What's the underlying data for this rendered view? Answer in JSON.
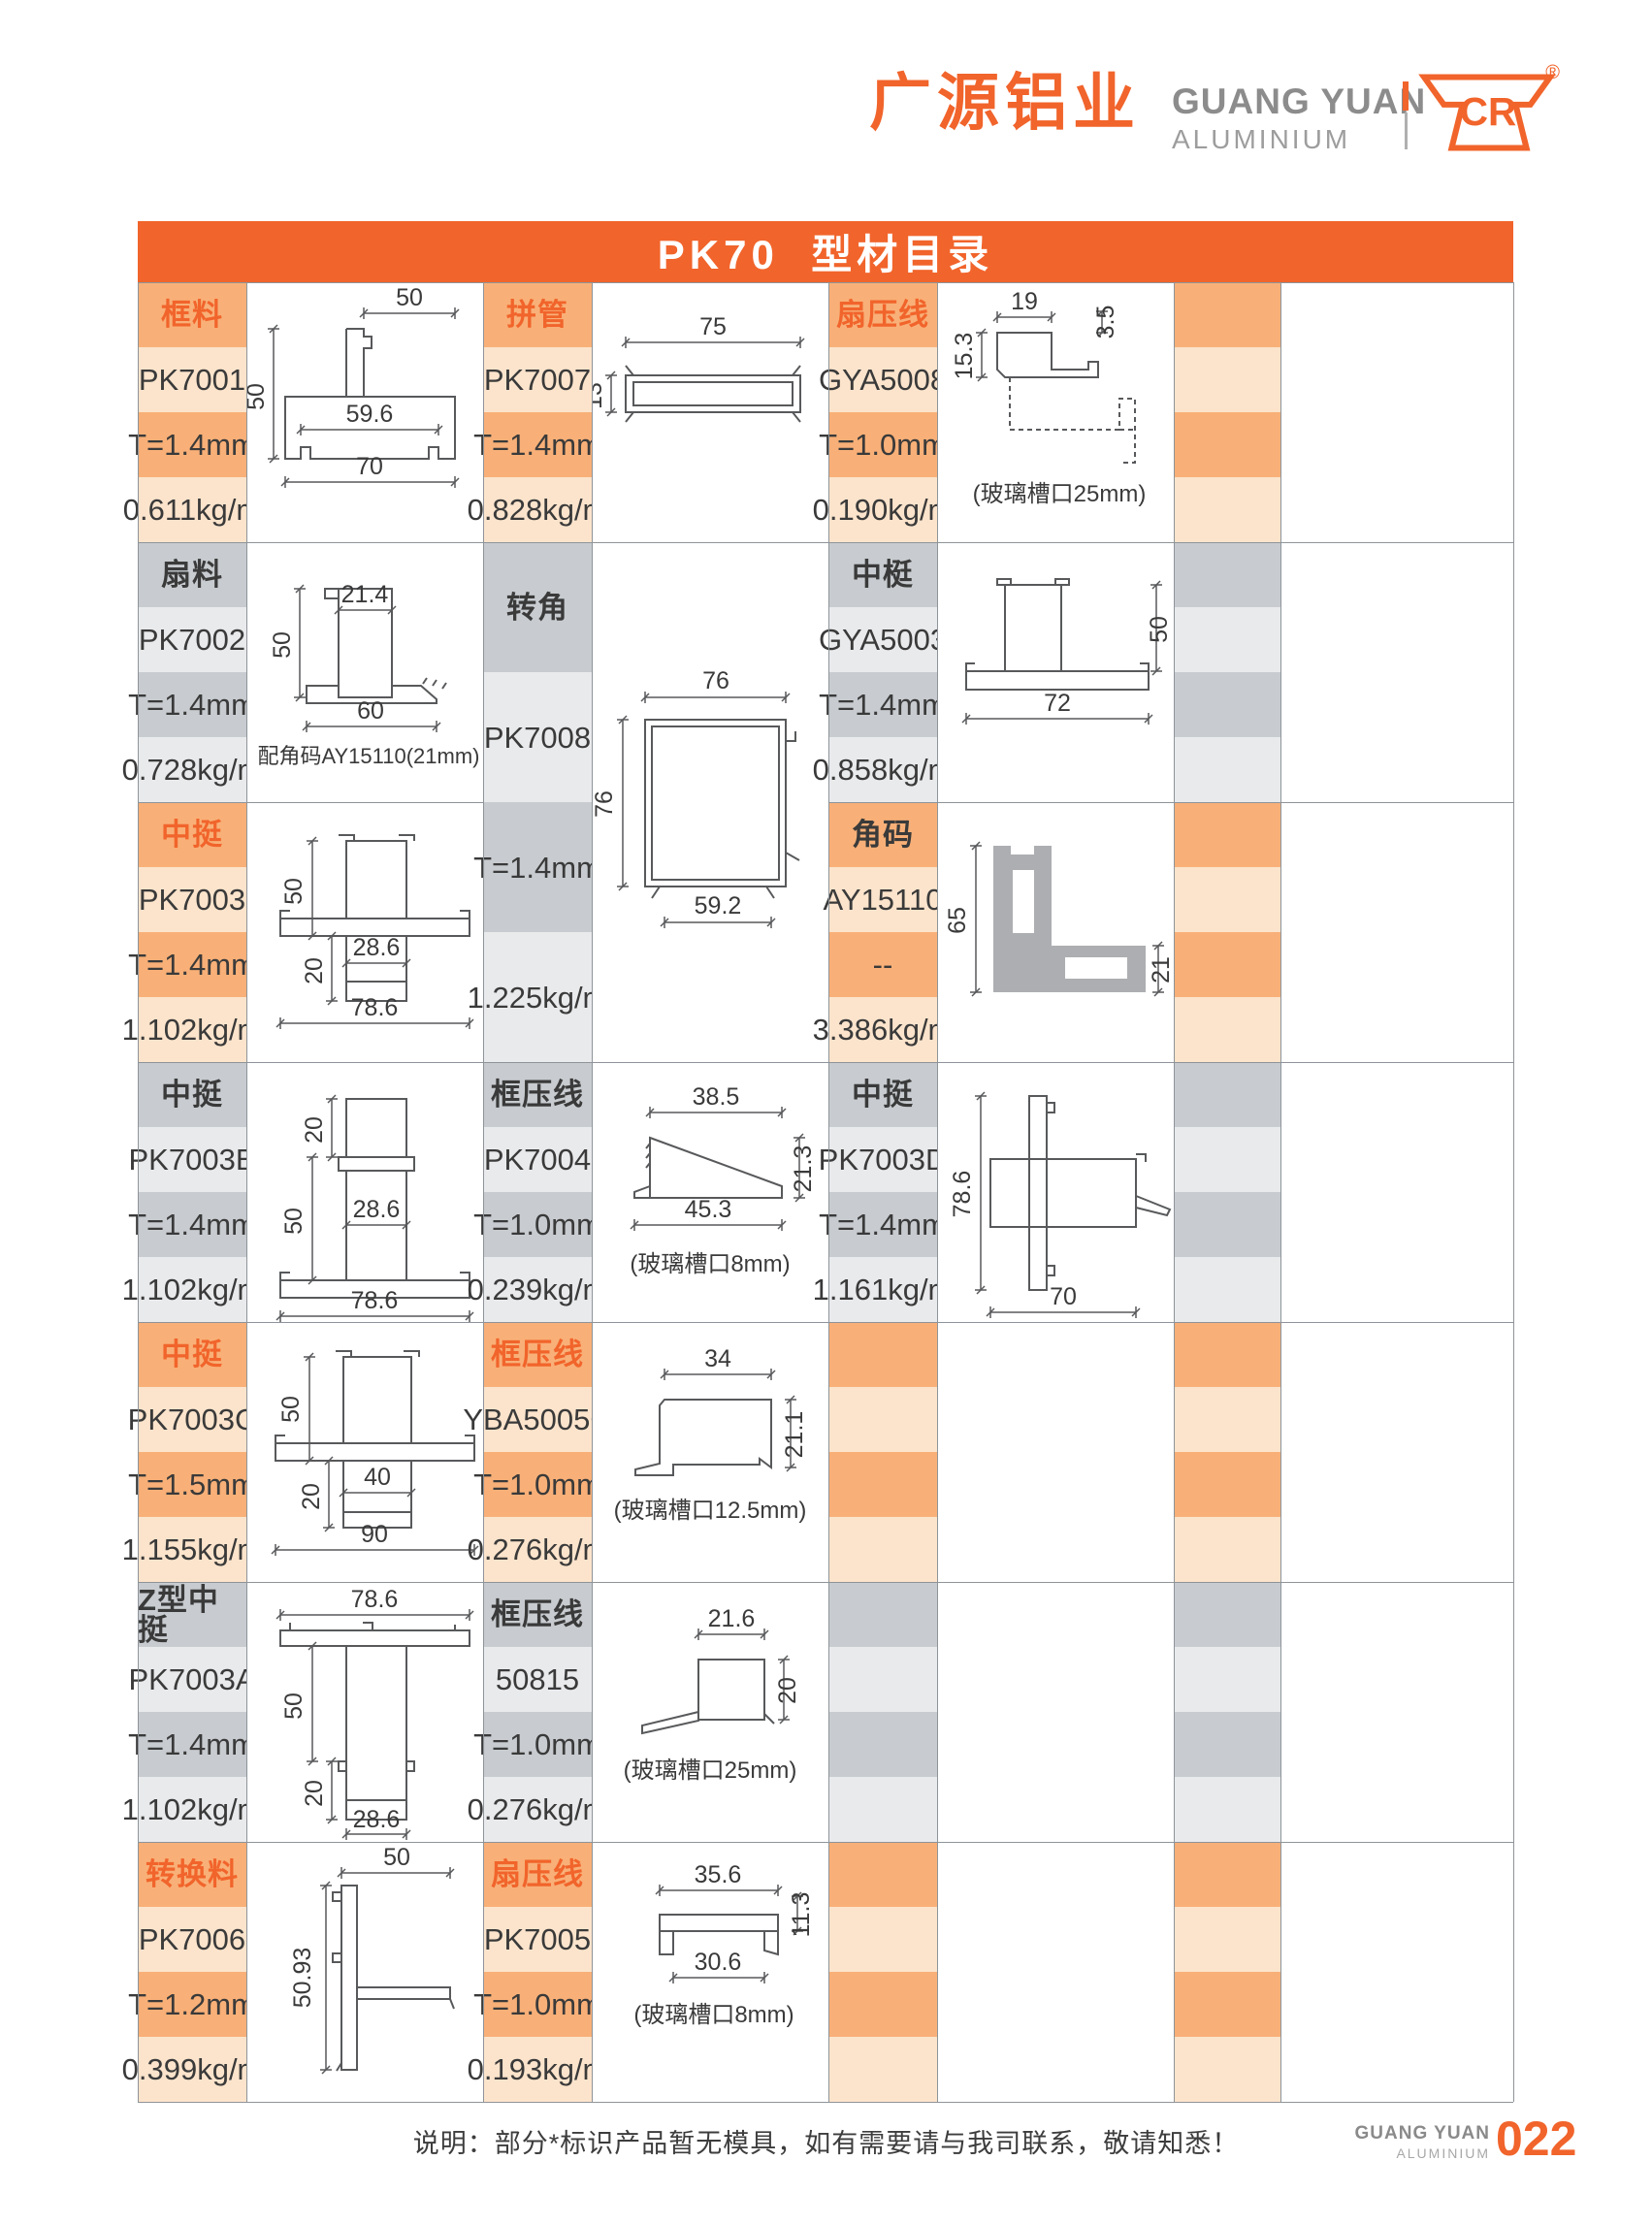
{
  "header": {
    "logo_cn": "广源铝业",
    "logo_en_line1": "GUANG YUAN",
    "logo_en_line2": "ALUMINIUM",
    "logo_mark": "CR",
    "registered": "®"
  },
  "table": {
    "title": "PK70  型材目录",
    "columns": [
      {
        "blocks": [
          {
            "theme": "orange",
            "category": "框料",
            "model": "PK7001",
            "thickness": "T=1.4mm",
            "weight": "0.611kg/m",
            "drawing": {
              "id": "pk7001",
              "dims": [
                "50",
                "50",
                "59.6",
                "70"
              ],
              "caption": null
            }
          },
          {
            "theme": "gray",
            "category": "扇料",
            "model": "PK7002",
            "thickness": "T=1.4mm",
            "weight": "0.728kg/m",
            "drawing": {
              "id": "pk7002",
              "dims": [
                "21.4",
                "50",
                "60"
              ],
              "caption": "配角码AY15110(21mm)"
            }
          },
          {
            "theme": "orange",
            "category": "中挺",
            "model": "PK7003",
            "thickness": "T=1.4mm",
            "weight": "1.102kg/m",
            "drawing": {
              "id": "pk7003",
              "dims": [
                "50",
                "20",
                "28.6",
                "78.6"
              ],
              "caption": null
            }
          },
          {
            "theme": "gray",
            "category": "中挺",
            "model": "PK7003B",
            "thickness": "T=1.4mm",
            "weight": "1.102kg/m",
            "drawing": {
              "id": "pk7003b",
              "dims": [
                "20",
                "50",
                "28.6",
                "78.6"
              ],
              "caption": null
            }
          },
          {
            "theme": "orange",
            "category": "中挺",
            "model": "PK7003C",
            "thickness": "T=1.5mm",
            "weight": "1.155kg/m",
            "drawing": {
              "id": "pk7003c",
              "dims": [
                "50",
                "20",
                "40",
                "90"
              ],
              "caption": null
            }
          },
          {
            "theme": "gray",
            "category": "Z型中挺",
            "model": "PK7003A",
            "thickness": "T=1.4mm",
            "weight": "1.102kg/m",
            "drawing": {
              "id": "pk7003a",
              "dims": [
                "78.6",
                "50",
                "20",
                "28.6"
              ],
              "caption": null
            }
          },
          {
            "theme": "orange",
            "category": "转换料",
            "model": "PK7006",
            "thickness": "T=1.2mm",
            "weight": "0.399kg/m",
            "drawing": {
              "id": "pk7006",
              "dims": [
                "50",
                "50.93"
              ],
              "caption": null
            }
          }
        ]
      },
      {
        "blocks": [
          {
            "theme": "orange",
            "category": "拼管",
            "model": "PK7007",
            "thickness": "T=1.4mm",
            "weight": "0.828kg/m",
            "drawing": {
              "id": "pk7007",
              "dims": [
                "75",
                "13"
              ],
              "caption": null
            }
          },
          {
            "theme": "gray",
            "category": "转角",
            "model": "PK7008",
            "thickness": "T=1.4mm",
            "weight": "1.225kg/m",
            "span_groups": 2,
            "drawing": {
              "id": "pk7008",
              "dims": [
                "76",
                "76",
                "59.2"
              ],
              "caption": null
            }
          },
          {
            "theme": "gray",
            "category": "框压线",
            "model": "PK7004",
            "thickness": "T=1.0mm",
            "weight": "0.239kg/m",
            "drawing": {
              "id": "pk7004",
              "dims": [
                "38.5",
                "21.3",
                "45.3"
              ],
              "caption": "(玻璃槽口8mm)"
            }
          },
          {
            "theme": "orange",
            "category": "框压线",
            "model": "YBA5005C",
            "thickness": "T=1.0mm",
            "weight": "0.276kg/m",
            "drawing": {
              "id": "yba5005c",
              "dims": [
                "34",
                "21.1"
              ],
              "caption": "(玻璃槽口12.5mm)"
            }
          },
          {
            "theme": "gray",
            "category": "框压线",
            "model": "50815",
            "thickness": "T=1.0mm",
            "weight": "0.276kg/m",
            "drawing": {
              "id": "p50815",
              "dims": [
                "21.6",
                "20"
              ],
              "caption": "(玻璃槽口25mm)"
            }
          },
          {
            "theme": "orange",
            "category": "扇压线",
            "model": "PK7005",
            "thickness": "T=1.0mm",
            "weight": "0.193kg/m",
            "drawing": {
              "id": "pk7005",
              "dims": [
                "35.6",
                "11.3",
                "30.6"
              ],
              "caption": "(玻璃槽口8mm)"
            }
          }
        ]
      },
      {
        "blocks": [
          {
            "theme": "orange",
            "category": "扇压线",
            "model": "GYA5008",
            "thickness": "T=1.0mm",
            "weight": "0.190kg/m",
            "drawing": {
              "id": "gya5008",
              "dims": [
                "19",
                "3.5",
                "15.3"
              ],
              "caption": "(玻璃槽口25mm)"
            }
          },
          {
            "theme": "gray",
            "category": "中梃",
            "model": "GYA5003",
            "thickness": "T=1.4mm",
            "weight": "0.858kg/m",
            "drawing": {
              "id": "gya5003",
              "dims": [
                "50",
                "72"
              ],
              "caption": null
            }
          },
          {
            "theme": "orange",
            "category": "角码",
            "model": "AY15110",
            "thickness": "--",
            "weight": "3.386kg/m",
            "category_dark": true,
            "drawing": {
              "id": "ay15110",
              "dims": [
                "65",
                "21"
              ],
              "caption": null
            }
          },
          {
            "theme": "gray",
            "category": "中挺",
            "model": "PK7003D",
            "thickness": "T=1.4mm",
            "weight": "1.161kg/m",
            "drawing": {
              "id": "pk7003d",
              "dims": [
                "78.6",
                "70"
              ],
              "caption": null
            }
          },
          {
            "theme": "orange",
            "empty": true
          },
          {
            "theme": "gray",
            "empty": true
          },
          {
            "theme": "orange",
            "empty": true
          }
        ]
      },
      {
        "blocks": [
          {
            "theme": "orange",
            "empty": true
          },
          {
            "theme": "gray",
            "empty": true
          },
          {
            "theme": "orange",
            "empty": true
          },
          {
            "theme": "gray",
            "empty": true
          },
          {
            "theme": "orange",
            "empty": true
          },
          {
            "theme": "gray",
            "empty": true
          },
          {
            "theme": "orange",
            "empty": true
          }
        ]
      }
    ]
  },
  "footer": {
    "note": "说明：部分*标识产品暂无模具，如有需要请与我司联系，敬请知悉！",
    "brand_line1": "GUANG YUAN",
    "brand_line2": "ALUMINIUM",
    "page": "022"
  },
  "colors": {
    "accent_orange": "#F1642B",
    "cell_orange_medium": "#F8B078",
    "cell_orange_light": "#FCE4CC",
    "cell_gray_medium": "#C8CCD0",
    "cell_gray_light": "#E9EAEC",
    "text_dark": "#3A3A3A",
    "grid_line": "#8E9499",
    "drawing_line": "#58595B",
    "bracket_fill": "#ACAEB1"
  }
}
